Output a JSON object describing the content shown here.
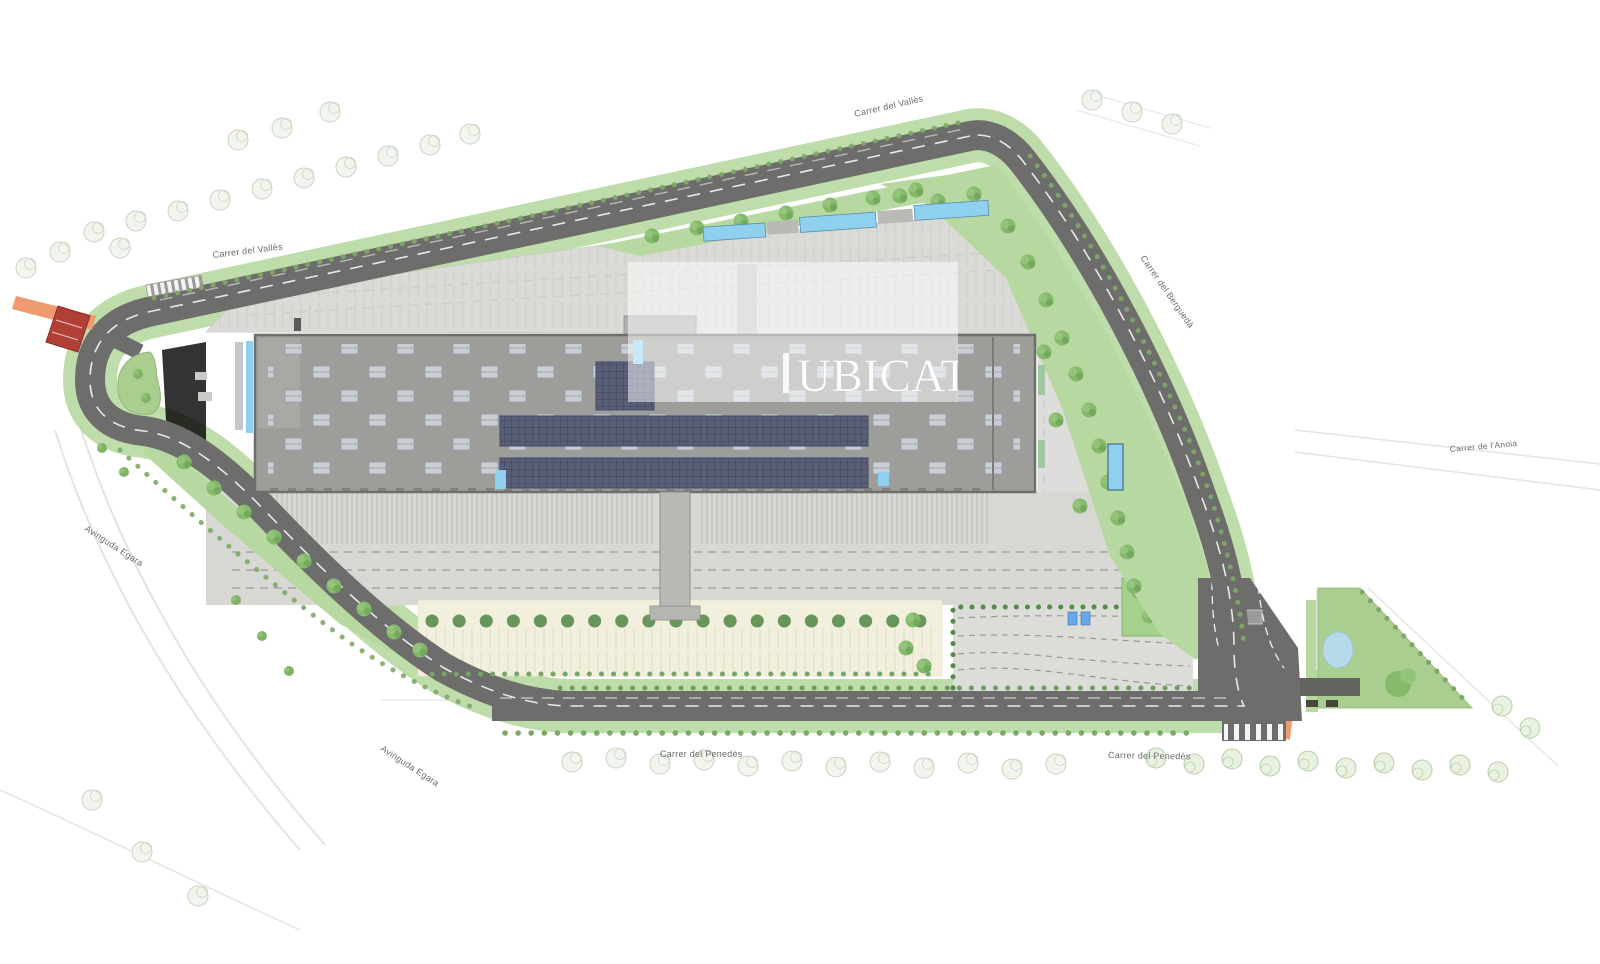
{
  "watermark": {
    "text": "UBICAT"
  },
  "street_labels": {
    "valles_top": "Carrer del Vallès",
    "valles_left": "Carrer del Vallès",
    "bergueda": "Carrer del Berguedà",
    "anoia": "Carrer de l'Anoia",
    "penedes_west": "Carrer del Penedès",
    "penedes_east": "Carrer del Penedès",
    "egara_north": "Avinguda Egara",
    "egara_south": "Avinguda Egara"
  },
  "colors": {
    "road": "#6d6d6b",
    "road_marking": "#f5f5f5",
    "green_strip": "#b7d9a1",
    "lawn": "#aace90",
    "tree": "#85b96b",
    "building_roof": "#9d9d9a",
    "skylight": "#c9ced3",
    "solar_panel": "#5a5f78",
    "glazing_cyan": "#8fd0ee",
    "asphalt_parking": "#dadad7",
    "cream_parking": "#f2efdc",
    "pond": "#b8d9ea",
    "bridge_red": "#b04036",
    "bridge_orange": "#ef9a70"
  }
}
